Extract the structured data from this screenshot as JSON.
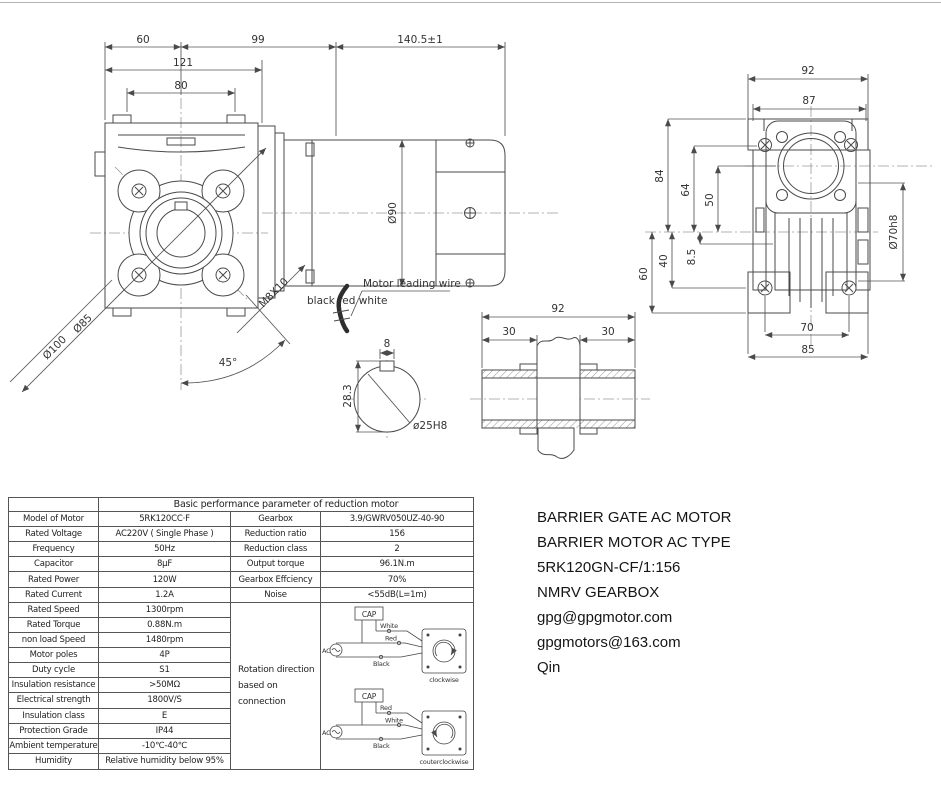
{
  "side_view": {
    "dim_60": "60",
    "dim_99": "99",
    "dim_140_5": "140.5±1",
    "dim_121": "121",
    "dim_80": "80",
    "dim_d90": "Ø90",
    "dim_d85": "Ø85",
    "dim_d100": "Ø100",
    "dim_45": "45°",
    "thread_label": "M8X10",
    "wire_note_1": "Motor leading wire",
    "wire_note_2": "black red white"
  },
  "front_view": {
    "dim_92": "92",
    "dim_87": "87",
    "dim_84": "84",
    "dim_64": "64",
    "dim_50": "50",
    "dim_40": "40",
    "dim_8_5": "8.5",
    "dim_60": "60",
    "dim_70": "70",
    "dim_85": "85",
    "dim_d70h8": "Ø70h8"
  },
  "shaft_view": {
    "dim_8": "8",
    "dim_28_3": "28.3",
    "dim_d25h8": "ø25H8",
    "dim_92": "92",
    "dim_30_left": "30",
    "dim_30_right": "30"
  },
  "table": {
    "title": "Basic performance parameter of reduction motor",
    "motor_rows": [
      {
        "label": "Model of Motor",
        "value": "5RK120CC·F"
      },
      {
        "label": "Rated Voltage",
        "value": "AC220V ( Single Phase )"
      },
      {
        "label": "Frequency",
        "value": "50Hz"
      },
      {
        "label": "Capacitor",
        "value": "8μF"
      },
      {
        "label": "Rated Power",
        "value": "120W"
      },
      {
        "label": "Rated Current",
        "value": "1.2A"
      },
      {
        "label": "Rated Speed",
        "value": "1300rpm"
      },
      {
        "label": "Rated Torque",
        "value": "0.88N.m"
      },
      {
        "label": "non load Speed",
        "value": "1480rpm"
      },
      {
        "label": "Motor poles",
        "value": "4P"
      },
      {
        "label": "Duty cycle",
        "value": "S1"
      },
      {
        "label": "Insulation resistance",
        "value": ">50MΩ"
      },
      {
        "label": "Electrical strength",
        "value": "1800V/S"
      },
      {
        "label": "Insulation class",
        "value": "E"
      },
      {
        "label": "Protection Grade",
        "value": "IP44"
      },
      {
        "label": "Ambient temperature",
        "value": "-10℃-40℃"
      },
      {
        "label": "Humidity",
        "value": "Relative humidity below 95%"
      }
    ],
    "gearbox_rows": [
      {
        "label": "Gearbox",
        "value": "3.9/GWRV050UZ-40-90"
      },
      {
        "label": "Reduction ratio",
        "value": "156"
      },
      {
        "label": "Reduction class",
        "value": "2"
      },
      {
        "label": "Output torque",
        "value": "96.1N.m"
      },
      {
        "label": "Gearbox Effciency",
        "value": "70%"
      },
      {
        "label": "Noise",
        "value": "<55dB(L=1m)"
      }
    ],
    "rotation_note_1": "Rotation direction",
    "rotation_note_2": "based on connection",
    "wiring": {
      "cap_label": "CAP",
      "ac_label": "AC",
      "cw": {
        "wire_top": "White",
        "wire_mid": "Red",
        "wire_bot": "Black",
        "caption": "clockwise"
      },
      "ccw": {
        "wire_top": "Red",
        "wire_mid": "White",
        "wire_bot": "Black",
        "caption": "couterclockwise"
      }
    }
  },
  "info_block": {
    "line1": "BARRIER GATE AC MOTOR",
    "line2": "BARRIER MOTOR AC TYPE",
    "line3": "5RK120GN-CF/1:156",
    "line4": "NMRV GEARBOX",
    "line5": "gpg@gpgmotor.com",
    "line6": "gpgmotors@163.com",
    "line7": "Qin"
  }
}
